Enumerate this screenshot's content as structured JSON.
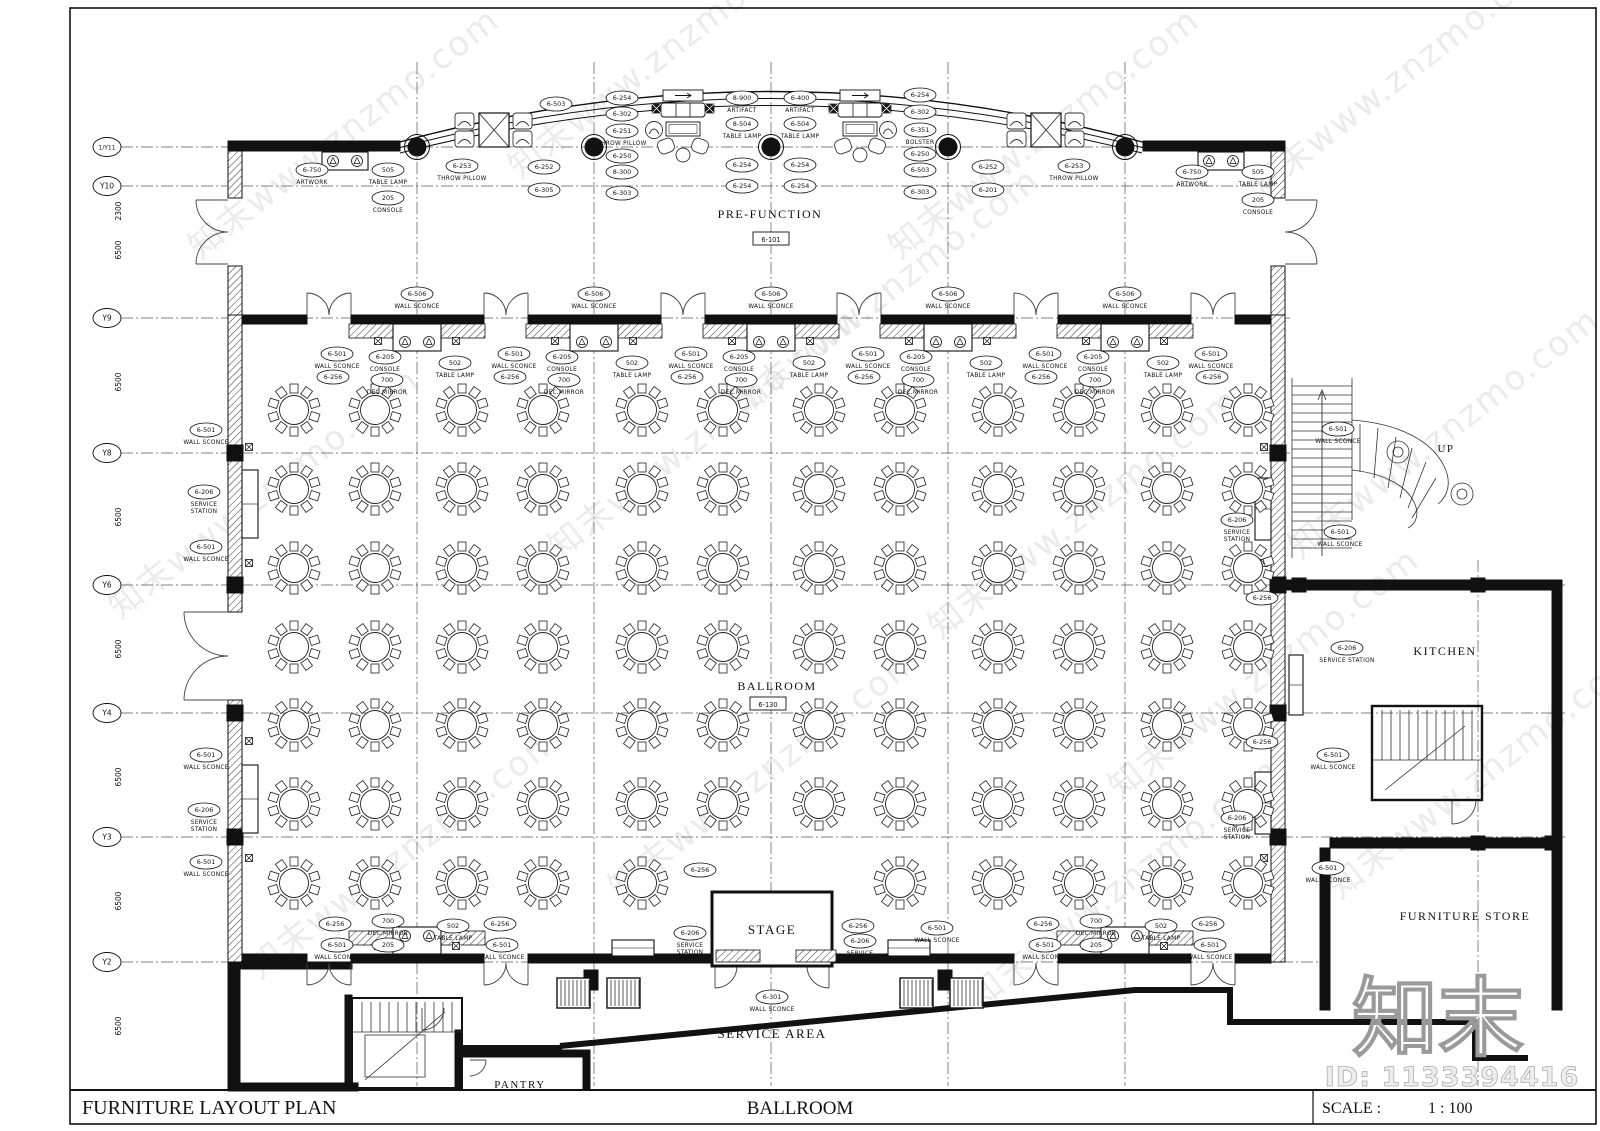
{
  "title_block": {
    "plan_title": "FURNITURE LAYOUT PLAN",
    "sheet_name": "BALLROOM",
    "scale_label": "SCALE :",
    "scale_value": "1 : 100"
  },
  "watermark": {
    "tile_text": "知末www.znzmo.com",
    "logo_text": "知末",
    "id_text": "ID: 1133394416"
  },
  "grid": {
    "rows": [
      {
        "label": "1/Y11",
        "y": 147,
        "dim": "2300",
        "end": 1285
      },
      {
        "label": "Y10",
        "y": 186,
        "dim": "6500",
        "end": 1285
      },
      {
        "label": "Y9",
        "y": 318,
        "dim": "6500",
        "end": 1290
      },
      {
        "label": "Y8",
        "y": 453,
        "dim": "6500",
        "end": 1290
      },
      {
        "label": "Y6",
        "y": 585,
        "dim": "6500",
        "end": 1565
      },
      {
        "label": "Y4",
        "y": 713,
        "dim": "6500",
        "end": 1565
      },
      {
        "label": "Y3",
        "y": 837,
        "dim": "6500",
        "end": 1565
      },
      {
        "label": "Y2",
        "y": 962,
        "dim": "6500",
        "end": 1330
      }
    ],
    "cols": [
      417,
      594,
      771,
      948,
      1125
    ],
    "col_extra": 1478
  },
  "rooms": [
    {
      "name": "PRE-FUNCTION",
      "x": 770,
      "y": 218,
      "size": 12,
      "tag": "6-101",
      "tag_x": 771,
      "tag_y": 239
    },
    {
      "name": "BALLROOM",
      "x": 777,
      "y": 690,
      "size": 12,
      "tag": "6-130",
      "tag_x": 768,
      "tag_y": 704
    },
    {
      "name": "STAGE",
      "x": 772,
      "y": 934,
      "size": 13
    },
    {
      "name": "SERVICE  AREA",
      "x": 772,
      "y": 1038,
      "size": 13
    },
    {
      "name": "PANTRY",
      "x": 520,
      "y": 1088,
      "size": 11
    },
    {
      "name": "KITCHEN",
      "x": 1445,
      "y": 655,
      "size": 12
    },
    {
      "name": "FURNITURE  STORE",
      "x": 1465,
      "y": 920,
      "size": 12
    },
    {
      "name": "UP",
      "x": 1446,
      "y": 452,
      "size": 11
    }
  ],
  "furniture": {
    "tables": {
      "cols": [
        294,
        375,
        462,
        543,
        642,
        723,
        819,
        900,
        998,
        1079,
        1167,
        1248
      ],
      "rows": [
        410,
        489,
        568,
        647,
        725,
        804,
        883
      ],
      "skip": [
        [
          6,
          5
        ],
        [
          6,
          6
        ]
      ]
    }
  },
  "callouts": [
    [
      312,
      170,
      "6-750",
      "ARTWORK"
    ],
    [
      388,
      170,
      "505",
      "TABLE LAMP"
    ],
    [
      388,
      198,
      "205",
      "CONSOLE"
    ],
    [
      1192,
      172,
      "6-750",
      "ARTWORK"
    ],
    [
      1258,
      172,
      "505",
      "TABLE LAMP"
    ],
    [
      1258,
      200,
      "205",
      "CONSOLE"
    ],
    [
      556,
      104,
      "6-503",
      ""
    ],
    [
      462,
      166,
      "6-253",
      "THROW PILLOW"
    ],
    [
      544,
      167,
      "6-252",
      ""
    ],
    [
      544,
      190,
      "6-305",
      ""
    ],
    [
      988,
      167,
      "6-252",
      ""
    ],
    [
      1074,
      166,
      "6-253",
      "THROW PILLOW"
    ],
    [
      988,
      190,
      "6-201",
      ""
    ],
    [
      622,
      98,
      "6-254",
      ""
    ],
    [
      622,
      114,
      "6-302",
      ""
    ],
    [
      622,
      131,
      "6-251",
      "THROW PILLOW"
    ],
    [
      622,
      156,
      "6-250",
      ""
    ],
    [
      622,
      172,
      "8-300",
      ""
    ],
    [
      622,
      193,
      "6-303",
      ""
    ],
    [
      742,
      98,
      "8-900",
      "ARTIFACT"
    ],
    [
      742,
      124,
      "8-504",
      "TABLE LAMP"
    ],
    [
      742,
      165,
      "6-254",
      ""
    ],
    [
      742,
      186,
      "6-254",
      ""
    ],
    [
      800,
      98,
      "6-400",
      "ARTIFACT"
    ],
    [
      800,
      124,
      "6-504",
      "TABLE LAMP"
    ],
    [
      800,
      165,
      "6-254",
      ""
    ],
    [
      800,
      186,
      "6-254",
      ""
    ],
    [
      920,
      95,
      "6-254",
      ""
    ],
    [
      920,
      112,
      "6-302",
      ""
    ],
    [
      920,
      130,
      "6-351",
      "BOLSTER"
    ],
    [
      920,
      154,
      "6-250",
      ""
    ],
    [
      920,
      170,
      "6-503",
      ""
    ],
    [
      920,
      192,
      "6-303",
      ""
    ],
    [
      417,
      294,
      "6-506",
      "WALL SCONCE"
    ],
    [
      594,
      294,
      "6-506",
      "WALL SCONCE"
    ],
    [
      771,
      294,
      "6-506",
      "WALL SCONCE"
    ],
    [
      948,
      294,
      "6-506",
      "WALL SCONCE"
    ],
    [
      1125,
      294,
      "6-506",
      "WALL SCONCE"
    ],
    [
      337,
      354,
      "6-501",
      "WALL SCONCE"
    ],
    [
      385,
      357,
      "6-205",
      "CONSOLE"
    ],
    [
      455,
      363,
      "502",
      "TABLE LAMP"
    ],
    [
      387,
      380,
      "700",
      "DEC.MIRROR"
    ],
    [
      333,
      377,
      "6-256",
      ""
    ],
    [
      514,
      354,
      "6-501",
      "WALL SCONCE"
    ],
    [
      562,
      357,
      "6-205",
      "CONSOLE"
    ],
    [
      632,
      363,
      "502",
      "TABLE LAMP"
    ],
    [
      564,
      380,
      "700",
      "DEC.MIRROR"
    ],
    [
      510,
      377,
      "6-256",
      ""
    ],
    [
      691,
      354,
      "6-501",
      "WALL SCONCE"
    ],
    [
      739,
      357,
      "6-205",
      "CONSOLE"
    ],
    [
      809,
      363,
      "502",
      "TABLE LAMP"
    ],
    [
      741,
      380,
      "700",
      "DEC.MIRROR"
    ],
    [
      687,
      377,
      "6-256",
      ""
    ],
    [
      868,
      354,
      "6-501",
      "WALL SCONCE"
    ],
    [
      916,
      357,
      "6-205",
      "CONSOLE"
    ],
    [
      986,
      363,
      "502",
      "TABLE LAMP"
    ],
    [
      918,
      380,
      "700",
      "DEC.MIRROR"
    ],
    [
      864,
      377,
      "6-256",
      ""
    ],
    [
      1045,
      354,
      "6-501",
      "WALL SCONCE"
    ],
    [
      1093,
      357,
      "6-205",
      "CONSOLE"
    ],
    [
      1163,
      363,
      "502",
      "TABLE LAMP"
    ],
    [
      1095,
      380,
      "700",
      "DEC.MIRROR"
    ],
    [
      1041,
      377,
      "6-256",
      ""
    ],
    [
      1211,
      354,
      "6-501",
      "WALL SCONCE"
    ],
    [
      1212,
      377,
      "6-256",
      ""
    ],
    [
      206,
      430,
      "6-501",
      "WALL SCONCE"
    ],
    [
      204,
      492,
      "6-206",
      "SERVICE|STATION"
    ],
    [
      206,
      547,
      "6-501",
      "WALL SCONCE"
    ],
    [
      206,
      755,
      "6-501",
      "WALL SCONCE"
    ],
    [
      204,
      810,
      "6-206",
      "SERVICE|STATION"
    ],
    [
      206,
      862,
      "6-501",
      "WALL SCONCE"
    ],
    [
      1237,
      520,
      "6-206",
      "SERVICE|STATION"
    ],
    [
      1262,
      598,
      "6-256",
      ""
    ],
    [
      1237,
      818,
      "6-206",
      "SERVICE|STATION"
    ],
    [
      1262,
      742,
      "6-256",
      ""
    ],
    [
      1338,
      429,
      "6-501",
      "WALL SCONCE"
    ],
    [
      1340,
      532,
      "6-501",
      "WALL SCONCE"
    ],
    [
      1347,
      648,
      "6-206",
      "SERVICE STATION"
    ],
    [
      1333,
      755,
      "6-501",
      "WALL SCONCE"
    ],
    [
      1328,
      868,
      "6-501",
      "WALL SCONCE"
    ],
    [
      335,
      924,
      "6-256",
      ""
    ],
    [
      388,
      921,
      "700",
      "DEC.MIRROR"
    ],
    [
      453,
      926,
      "502",
      "TABLE LAMP"
    ],
    [
      500,
      924,
      "6-256",
      ""
    ],
    [
      337,
      945,
      "6-501",
      "WALL SCONCE"
    ],
    [
      388,
      945,
      "205",
      "CONSOLE"
    ],
    [
      502,
      945,
      "6-501",
      "WALL SCONCE"
    ],
    [
      1043,
      924,
      "6-256",
      ""
    ],
    [
      1096,
      921,
      "700",
      "DEC.MIRROR"
    ],
    [
      1161,
      926,
      "502",
      "TABLE LAMP"
    ],
    [
      1208,
      924,
      "6-256",
      ""
    ],
    [
      1045,
      945,
      "6-501",
      "WALL SCONCE"
    ],
    [
      1096,
      945,
      "205",
      "CONSOLE"
    ],
    [
      1210,
      945,
      "6-501",
      "WALL SCONCE"
    ],
    [
      700,
      870,
      "6-256",
      ""
    ],
    [
      690,
      933,
      "6-206",
      "SERVICE|STATION"
    ],
    [
      858,
      926,
      "6-256",
      ""
    ],
    [
      860,
      941,
      "6-206",
      "SERVICE|STATION"
    ],
    [
      937,
      928,
      "6-501",
      "WALL SCONCE"
    ],
    [
      772,
      997,
      "6-301",
      "WALL SCONCE"
    ]
  ]
}
